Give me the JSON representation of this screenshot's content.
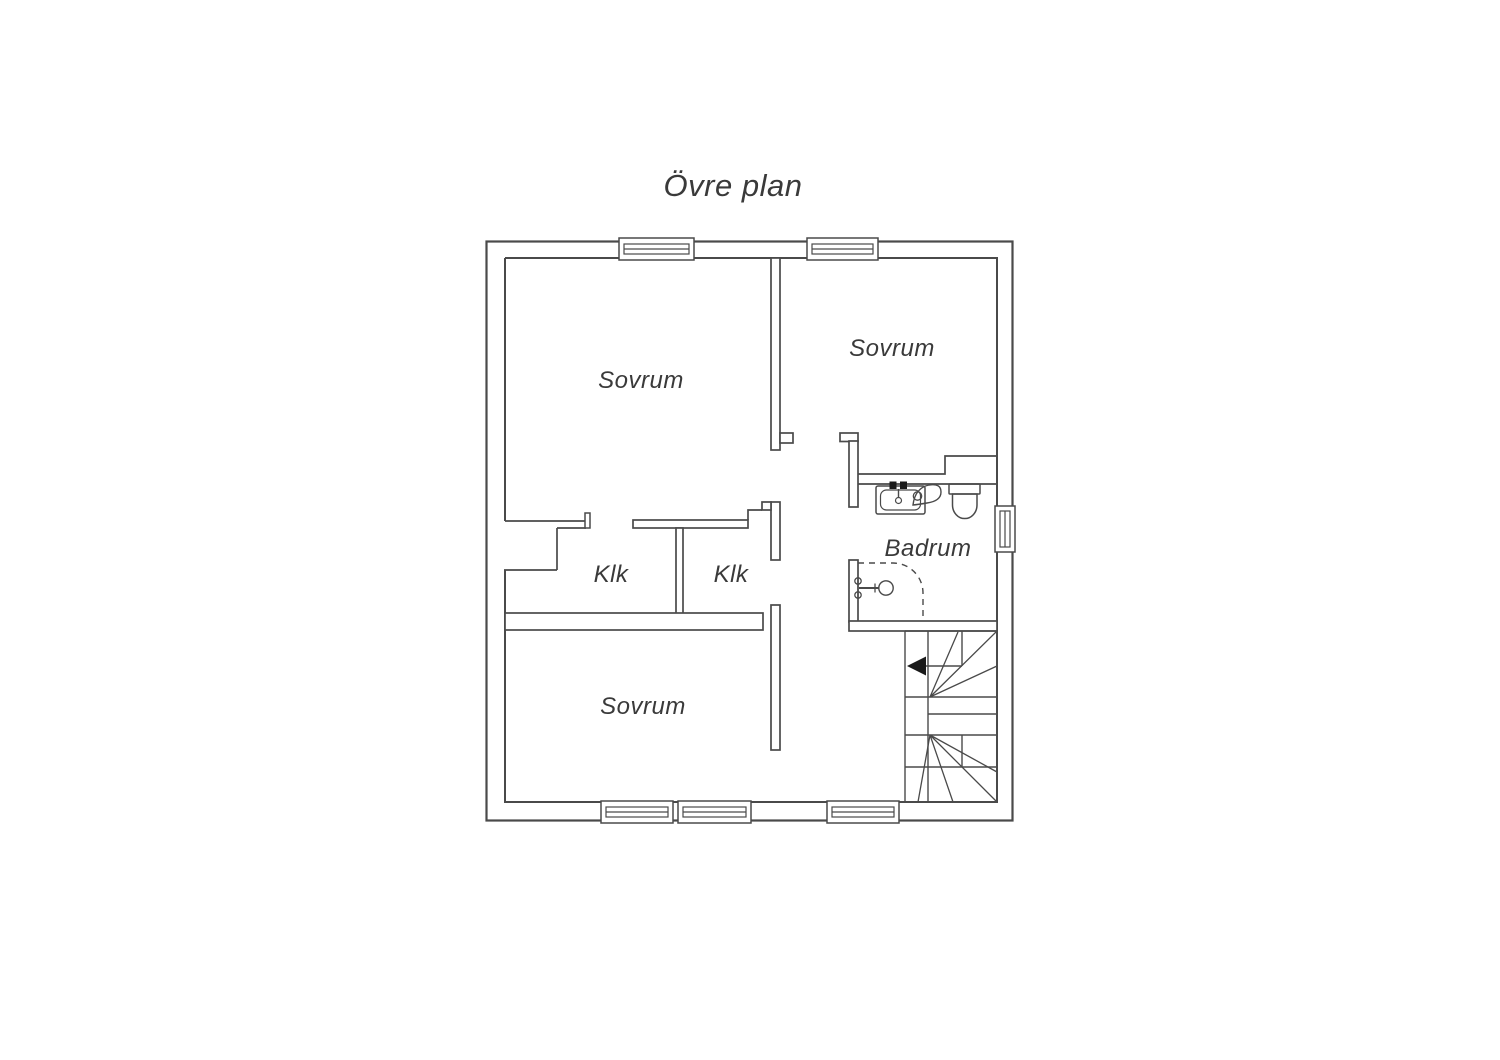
{
  "title": "Övre plan",
  "floor_plan": {
    "rooms": [
      {
        "id": "sovrum-top-left",
        "label": "Sovrum"
      },
      {
        "id": "sovrum-top-right",
        "label": "Sovrum"
      },
      {
        "id": "sovrum-bottom",
        "label": "Sovrum"
      },
      {
        "id": "klk-left",
        "label": "Klk"
      },
      {
        "id": "klk-right",
        "label": "Klk"
      },
      {
        "id": "badrum",
        "label": "Badrum"
      }
    ],
    "fixtures": [
      "sink",
      "toilet",
      "shower"
    ],
    "symbols": {
      "window_count": 6,
      "stair_arrow_direction": "left"
    },
    "colors": {
      "wall_line": "#4a4a4a",
      "text": "#3a3a3a",
      "arrow": "#1a1a1a",
      "background": "#ffffff"
    }
  }
}
